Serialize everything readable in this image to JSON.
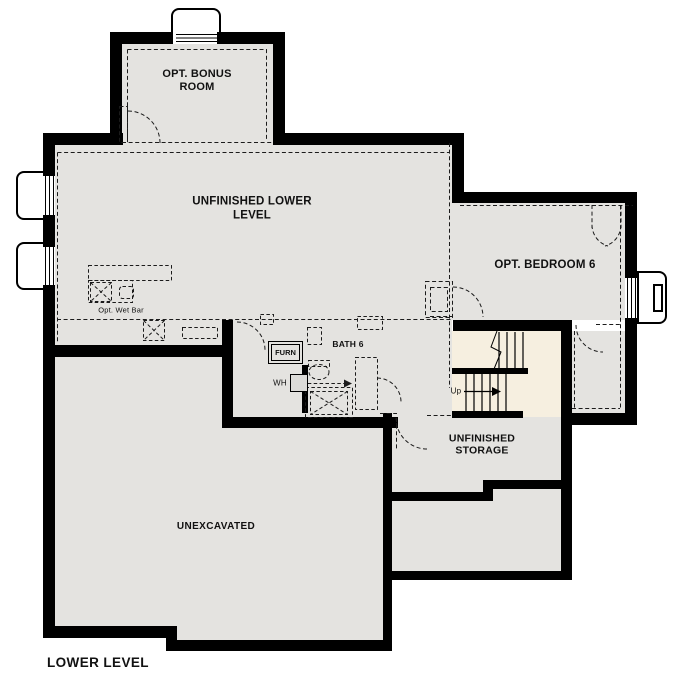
{
  "plan": {
    "title": "LOWER LEVEL",
    "rooms": {
      "bonus_room": "OPT. BONUS ROOM",
      "unfinished_lower_level": "UNFINISHED LOWER LEVEL",
      "opt_bedroom_6": "OPT. BEDROOM 6",
      "bath_6": "BATH 6",
      "unfinished_storage": "UNFINISHED STORAGE",
      "unexcavated": "UNEXCAVATED"
    },
    "features": {
      "opt_wet_bar": "Opt. Wet Bar",
      "furnace": "FURN",
      "water_heater": "WH",
      "stair_direction": "Up"
    },
    "colors": {
      "wall": "#000000",
      "floor": "#e4e3e0",
      "stair_area": "#f6efe0",
      "line": "#1b1b1b",
      "background": "#ffffff"
    }
  }
}
